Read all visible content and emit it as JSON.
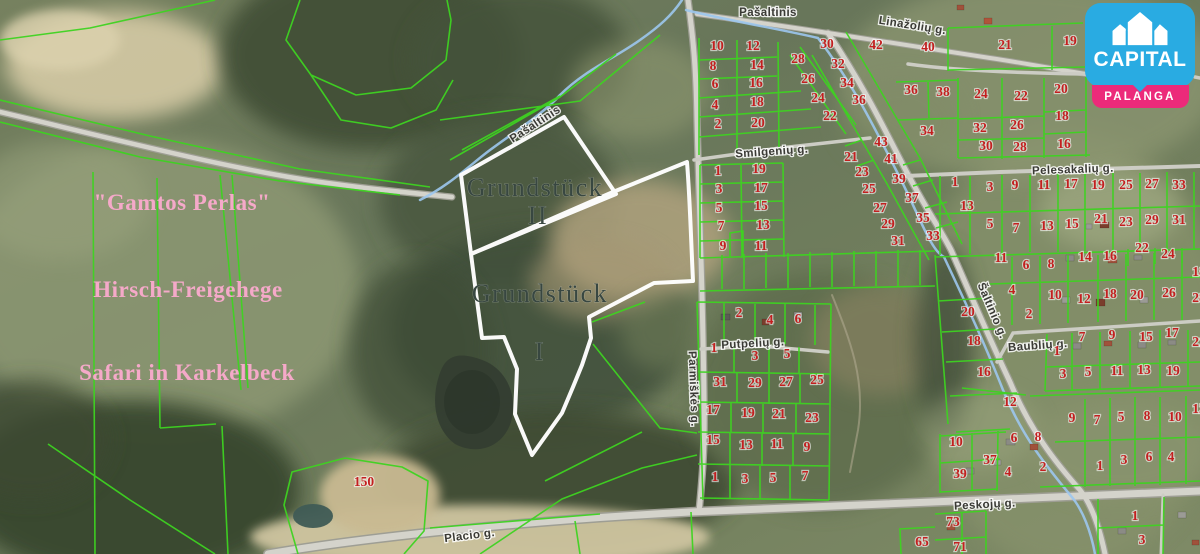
{
  "logo": {
    "brand": "CAPITAL",
    "city": "PALANGA"
  },
  "colors": {
    "parcel_line_green": "#3ed321",
    "parcel_number_red": "#c31f1f",
    "white_boundary": "#ffffff",
    "logo_blue": "#29abe2",
    "logo_pink": "#ec2a7a",
    "pink_label": "#f5a9c9",
    "street_text": "#3a3a35",
    "stream_text_blue": "#3b62c0"
  },
  "area_labels": [
    {
      "text": "\"Gamtos Perlas\"",
      "x": 182,
      "y": 210
    },
    {
      "text": "Hirsch-Freigehege",
      "x": 188,
      "y": 297
    },
    {
      "text": "Safari in Karkelbeck",
      "x": 187,
      "y": 380
    }
  ],
  "plot_labels": [
    {
      "text": "Grundstück",
      "x": 535,
      "y": 196
    },
    {
      "text": "II",
      "x": 538,
      "y": 224
    },
    {
      "text": "Grundstück",
      "x": 540,
      "y": 302
    },
    {
      "text": "I",
      "x": 540,
      "y": 360
    }
  ],
  "street_labels": [
    {
      "text": "Pašaltinis",
      "x": 768,
      "y": 16,
      "angle": 0,
      "color": "#3b62c0",
      "size": 12.5
    },
    {
      "text": "Pašaltinis",
      "x": 537,
      "y": 127,
      "angle": -33,
      "color": "#3b62c0",
      "size": 9.5
    },
    {
      "text": "Linažolių g.",
      "x": 912,
      "y": 29,
      "angle": 9
    },
    {
      "text": "Smilgenių g.",
      "x": 772,
      "y": 155,
      "angle": -4
    },
    {
      "text": "Pelesakalių g.",
      "x": 1073,
      "y": 173,
      "angle": -2
    },
    {
      "text": "Šaltinio g.",
      "x": 989,
      "y": 312,
      "angle": 67
    },
    {
      "text": "Baublių g.",
      "x": 1038,
      "y": 349,
      "angle": -4
    },
    {
      "text": "Putpelių g.",
      "x": 753,
      "y": 347,
      "angle": -3
    },
    {
      "text": "Parmiškės g.",
      "x": 690,
      "y": 389,
      "angle": 88
    },
    {
      "text": "Placio g.",
      "x": 470,
      "y": 539,
      "angle": -7
    },
    {
      "text": "Peskojų g.",
      "x": 985,
      "y": 508,
      "angle": -3
    }
  ],
  "parcel_numbers": [
    {
      "n": "10",
      "x": 717,
      "y": 50
    },
    {
      "n": "12",
      "x": 753,
      "y": 50
    },
    {
      "n": "30",
      "x": 827,
      "y": 48
    },
    {
      "n": "42",
      "x": 876,
      "y": 49
    },
    {
      "n": "40",
      "x": 928,
      "y": 51
    },
    {
      "n": "8",
      "x": 713,
      "y": 70
    },
    {
      "n": "14",
      "x": 757,
      "y": 69
    },
    {
      "n": "28",
      "x": 798,
      "y": 63
    },
    {
      "n": "32",
      "x": 838,
      "y": 68
    },
    {
      "n": "6",
      "x": 715,
      "y": 88
    },
    {
      "n": "16",
      "x": 756,
      "y": 87
    },
    {
      "n": "26",
      "x": 808,
      "y": 83
    },
    {
      "n": "34",
      "x": 847,
      "y": 87
    },
    {
      "n": "4",
      "x": 715,
      "y": 109
    },
    {
      "n": "18",
      "x": 757,
      "y": 106
    },
    {
      "n": "24",
      "x": 818,
      "y": 102
    },
    {
      "n": "36",
      "x": 859,
      "y": 104
    },
    {
      "n": "2",
      "x": 718,
      "y": 128
    },
    {
      "n": "20",
      "x": 758,
      "y": 127
    },
    {
      "n": "22",
      "x": 830,
      "y": 120
    },
    {
      "n": "36",
      "x": 911,
      "y": 94
    },
    {
      "n": "38",
      "x": 943,
      "y": 96
    },
    {
      "n": "34",
      "x": 927,
      "y": 135
    },
    {
      "n": "43",
      "x": 881,
      "y": 146
    },
    {
      "n": "21",
      "x": 851,
      "y": 161
    },
    {
      "n": "41",
      "x": 891,
      "y": 163
    },
    {
      "n": "1",
      "x": 718,
      "y": 175
    },
    {
      "n": "19",
      "x": 759,
      "y": 173
    },
    {
      "n": "3",
      "x": 719,
      "y": 193
    },
    {
      "n": "17",
      "x": 761,
      "y": 192
    },
    {
      "n": "5",
      "x": 719,
      "y": 212
    },
    {
      "n": "15",
      "x": 761,
      "y": 210
    },
    {
      "n": "7",
      "x": 721,
      "y": 230
    },
    {
      "n": "13",
      "x": 763,
      "y": 229
    },
    {
      "n": "9",
      "x": 723,
      "y": 250
    },
    {
      "n": "11",
      "x": 761,
      "y": 250
    },
    {
      "n": "23",
      "x": 862,
      "y": 176
    },
    {
      "n": "39",
      "x": 899,
      "y": 183
    },
    {
      "n": "25",
      "x": 869,
      "y": 193
    },
    {
      "n": "37",
      "x": 912,
      "y": 202
    },
    {
      "n": "27",
      "x": 880,
      "y": 212
    },
    {
      "n": "35",
      "x": 923,
      "y": 222
    },
    {
      "n": "29",
      "x": 888,
      "y": 228
    },
    {
      "n": "33",
      "x": 933,
      "y": 240
    },
    {
      "n": "31",
      "x": 898,
      "y": 245
    },
    {
      "n": "21",
      "x": 1005,
      "y": 49
    },
    {
      "n": "19",
      "x": 1070,
      "y": 45
    },
    {
      "n": "24",
      "x": 981,
      "y": 98
    },
    {
      "n": "22",
      "x": 1021,
      "y": 100
    },
    {
      "n": "20",
      "x": 1061,
      "y": 93
    },
    {
      "n": "18",
      "x": 1062,
      "y": 120
    },
    {
      "n": "32",
      "x": 980,
      "y": 132
    },
    {
      "n": "26",
      "x": 1017,
      "y": 129
    },
    {
      "n": "30",
      "x": 986,
      "y": 150
    },
    {
      "n": "28",
      "x": 1020,
      "y": 151
    },
    {
      "n": "16",
      "x": 1064,
      "y": 148
    },
    {
      "n": "1",
      "x": 955,
      "y": 186
    },
    {
      "n": "3",
      "x": 990,
      "y": 191
    },
    {
      "n": "9",
      "x": 1015,
      "y": 189
    },
    {
      "n": "11",
      "x": 1044,
      "y": 189
    },
    {
      "n": "17",
      "x": 1071,
      "y": 188
    },
    {
      "n": "19",
      "x": 1098,
      "y": 189
    },
    {
      "n": "25",
      "x": 1126,
      "y": 189
    },
    {
      "n": "27",
      "x": 1152,
      "y": 188
    },
    {
      "n": "33",
      "x": 1179,
      "y": 189
    },
    {
      "n": "13",
      "x": 967,
      "y": 210
    },
    {
      "n": "5",
      "x": 990,
      "y": 228
    },
    {
      "n": "7",
      "x": 1016,
      "y": 232
    },
    {
      "n": "13",
      "x": 1047,
      "y": 230
    },
    {
      "n": "15",
      "x": 1072,
      "y": 228
    },
    {
      "n": "21",
      "x": 1101,
      "y": 223
    },
    {
      "n": "23",
      "x": 1126,
      "y": 226
    },
    {
      "n": "29",
      "x": 1152,
      "y": 224
    },
    {
      "n": "31",
      "x": 1179,
      "y": 224
    },
    {
      "n": "22",
      "x": 1142,
      "y": 252
    },
    {
      "n": "24",
      "x": 1168,
      "y": 258
    },
    {
      "n": "18",
      "x": 1199,
      "y": 276
    },
    {
      "n": "28",
      "x": 1199,
      "y": 302
    },
    {
      "n": "11",
      "x": 1001,
      "y": 262
    },
    {
      "n": "6",
      "x": 1026,
      "y": 269
    },
    {
      "n": "8",
      "x": 1051,
      "y": 268
    },
    {
      "n": "14",
      "x": 1085,
      "y": 261
    },
    {
      "n": "16",
      "x": 1110,
      "y": 260
    },
    {
      "n": "4",
      "x": 1012,
      "y": 294
    },
    {
      "n": "10",
      "x": 1055,
      "y": 299
    },
    {
      "n": "12",
      "x": 1084,
      "y": 303
    },
    {
      "n": "18",
      "x": 1110,
      "y": 298
    },
    {
      "n": "20",
      "x": 1137,
      "y": 299
    },
    {
      "n": "26",
      "x": 1169,
      "y": 297
    },
    {
      "n": "20",
      "x": 968,
      "y": 316
    },
    {
      "n": "2",
      "x": 1029,
      "y": 318
    },
    {
      "n": "18",
      "x": 974,
      "y": 345
    },
    {
      "n": "16",
      "x": 984,
      "y": 376
    },
    {
      "n": "1",
      "x": 1057,
      "y": 355
    },
    {
      "n": "7",
      "x": 1082,
      "y": 341
    },
    {
      "n": "9",
      "x": 1112,
      "y": 339
    },
    {
      "n": "15",
      "x": 1146,
      "y": 341
    },
    {
      "n": "17",
      "x": 1172,
      "y": 337
    },
    {
      "n": "21",
      "x": 1199,
      "y": 346
    },
    {
      "n": "3",
      "x": 1063,
      "y": 378
    },
    {
      "n": "5",
      "x": 1088,
      "y": 376
    },
    {
      "n": "11",
      "x": 1117,
      "y": 375
    },
    {
      "n": "13",
      "x": 1144,
      "y": 374
    },
    {
      "n": "19",
      "x": 1173,
      "y": 375
    },
    {
      "n": "12",
      "x": 1010,
      "y": 406
    },
    {
      "n": "9",
      "x": 1072,
      "y": 422
    },
    {
      "n": "7",
      "x": 1097,
      "y": 424
    },
    {
      "n": "5",
      "x": 1121,
      "y": 421
    },
    {
      "n": "8",
      "x": 1147,
      "y": 420
    },
    {
      "n": "10",
      "x": 1175,
      "y": 421
    },
    {
      "n": "12",
      "x": 1199,
      "y": 413
    },
    {
      "n": "10",
      "x": 956,
      "y": 446
    },
    {
      "n": "6",
      "x": 1014,
      "y": 442
    },
    {
      "n": "8",
      "x": 1038,
      "y": 441
    },
    {
      "n": "37",
      "x": 990,
      "y": 464
    },
    {
      "n": "39",
      "x": 960,
      "y": 478
    },
    {
      "n": "4",
      "x": 1008,
      "y": 476
    },
    {
      "n": "2",
      "x": 1043,
      "y": 471
    },
    {
      "n": "1",
      "x": 1100,
      "y": 470
    },
    {
      "n": "3",
      "x": 1124,
      "y": 464
    },
    {
      "n": "6",
      "x": 1149,
      "y": 461
    },
    {
      "n": "4",
      "x": 1171,
      "y": 461
    },
    {
      "n": "73",
      "x": 953,
      "y": 526
    },
    {
      "n": "71",
      "x": 960,
      "y": 551
    },
    {
      "n": "65",
      "x": 922,
      "y": 546
    },
    {
      "n": "1",
      "x": 1135,
      "y": 520
    },
    {
      "n": "3",
      "x": 1142,
      "y": 544
    },
    {
      "n": "2",
      "x": 739,
      "y": 317
    },
    {
      "n": "4",
      "x": 770,
      "y": 324
    },
    {
      "n": "6",
      "x": 798,
      "y": 323
    },
    {
      "n": "1",
      "x": 714,
      "y": 352
    },
    {
      "n": "3",
      "x": 755,
      "y": 360
    },
    {
      "n": "5",
      "x": 787,
      "y": 358
    },
    {
      "n": "31",
      "x": 720,
      "y": 386
    },
    {
      "n": "29",
      "x": 755,
      "y": 387
    },
    {
      "n": "27",
      "x": 786,
      "y": 386
    },
    {
      "n": "25",
      "x": 817,
      "y": 384
    },
    {
      "n": "17",
      "x": 713,
      "y": 414
    },
    {
      "n": "19",
      "x": 748,
      "y": 417
    },
    {
      "n": "21",
      "x": 779,
      "y": 418
    },
    {
      "n": "23",
      "x": 812,
      "y": 422
    },
    {
      "n": "15",
      "x": 713,
      "y": 444
    },
    {
      "n": "13",
      "x": 746,
      "y": 449
    },
    {
      "n": "11",
      "x": 777,
      "y": 448
    },
    {
      "n": "9",
      "x": 807,
      "y": 451
    },
    {
      "n": "1",
      "x": 715,
      "y": 481
    },
    {
      "n": "3",
      "x": 745,
      "y": 483
    },
    {
      "n": "5",
      "x": 773,
      "y": 482
    },
    {
      "n": "7",
      "x": 805,
      "y": 480
    },
    {
      "n": "150",
      "x": 364,
      "y": 486
    }
  ]
}
